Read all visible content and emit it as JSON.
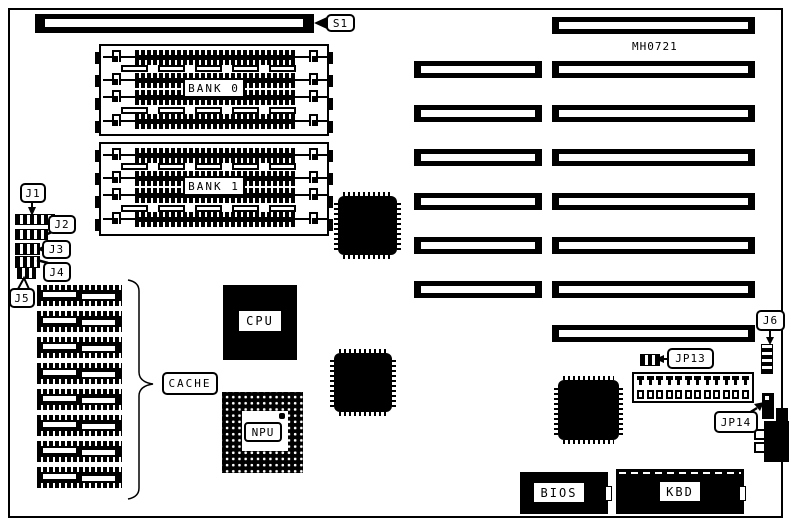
{
  "board": {
    "model": "MH0721",
    "background": "#ffffff",
    "ink": "#000000"
  },
  "labels": {
    "s1": "S1",
    "bank0": "BANK 0",
    "bank1": "BANK 1",
    "j1": "J1",
    "j2": "J2",
    "j3": "J3",
    "j4": "J4",
    "j5": "J5",
    "j6": "J6",
    "jp13": "JP13",
    "jp14": "JP14",
    "cache": "CACHE",
    "cpu": "CPU",
    "npu": "NPU",
    "bios": "BIOS",
    "kbd": "KBD"
  },
  "structure": {
    "isa_long_slot_count": 8,
    "isa_short_slot_count": 6,
    "cache_chip_count": 8,
    "memory_banks": 2,
    "memory_socket_rows_per_bank": 4,
    "memory_tab_columns": 5,
    "power_connector_pin_count": 12,
    "keyboard_connector_tab_count": 2
  }
}
